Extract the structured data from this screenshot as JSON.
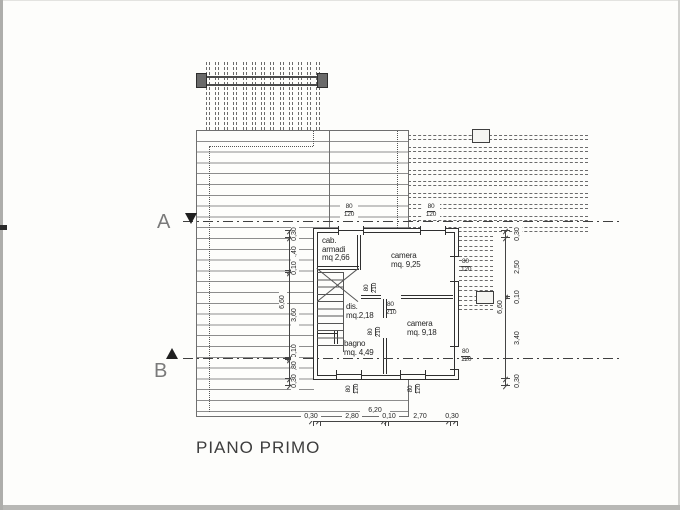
{
  "title": "PIANO PRIMO",
  "sections": {
    "a": "A",
    "b": "B"
  },
  "rooms": {
    "cab_armadi": {
      "lines": [
        "cab.",
        "armadi",
        "mq 2,66"
      ]
    },
    "camera1": {
      "lines": [
        "camera",
        "mq.  9,25"
      ]
    },
    "dis": {
      "lines": [
        "dis.",
        "mq.2,18"
      ]
    },
    "bagno": {
      "lines": [
        "bagno",
        "mq.  4,49"
      ]
    },
    "camera2": {
      "lines": [
        "camera",
        "mq.  9,18"
      ]
    }
  },
  "openings": {
    "door": {
      "w": "80",
      "h": "210"
    },
    "window": {
      "w": "80",
      "h": "120"
    }
  },
  "dims": {
    "bottom": {
      "total": "6,20",
      "segs": [
        "0,30",
        "2,80",
        "0,10",
        "2,70",
        "0,30"
      ]
    },
    "left": {
      "total": "6,60",
      "segs": [
        "0,30",
        "1,40",
        "0,10",
        "3,60",
        "0,10",
        "0,80",
        "0,30"
      ]
    },
    "right": {
      "total": "6,60",
      "segs": [
        "0,30",
        "2,50",
        "0,10",
        "3,40",
        "0,30"
      ]
    }
  },
  "colors": {
    "wall": "#2f2f2f",
    "roof_line": "#8d8d8d",
    "dim": "#444444",
    "paper": "#fdfdfb"
  }
}
